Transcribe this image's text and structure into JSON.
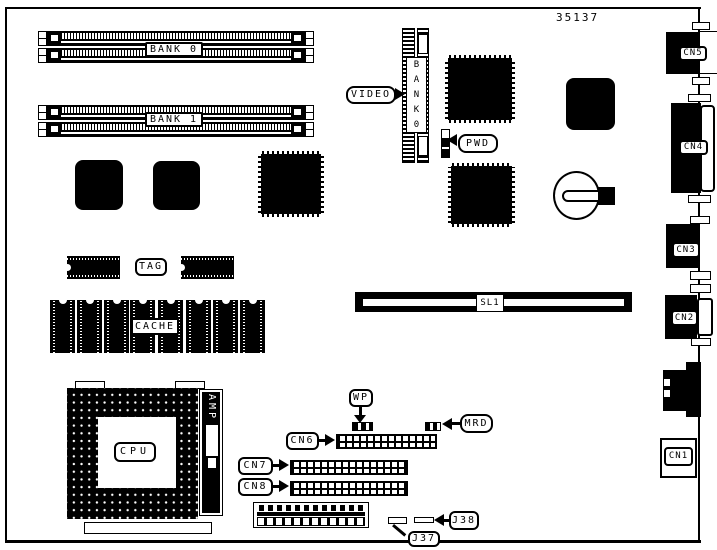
{
  "part_number": "35137",
  "colors": {
    "ink": "#000000",
    "paper": "#ffffff"
  },
  "labels": {
    "bank0": "BANK 0",
    "bank1": "BANK 1",
    "video": "VIDEO",
    "video_bank": "BANK0",
    "pwd": "PWD",
    "tag": "TAG",
    "cache": "CACHE",
    "sl1": "SL1",
    "cpu": "CPU",
    "amp": "AMP",
    "wp": "WP",
    "mrd": "MRD",
    "cn6": "CN6",
    "cn7": "CN7",
    "cn8": "CN8",
    "j37": "J37",
    "j38": "J38",
    "cn1": "CN1",
    "cn2": "CN2",
    "cn3": "CN3",
    "cn4": "CN4",
    "cn5": "CN5"
  }
}
